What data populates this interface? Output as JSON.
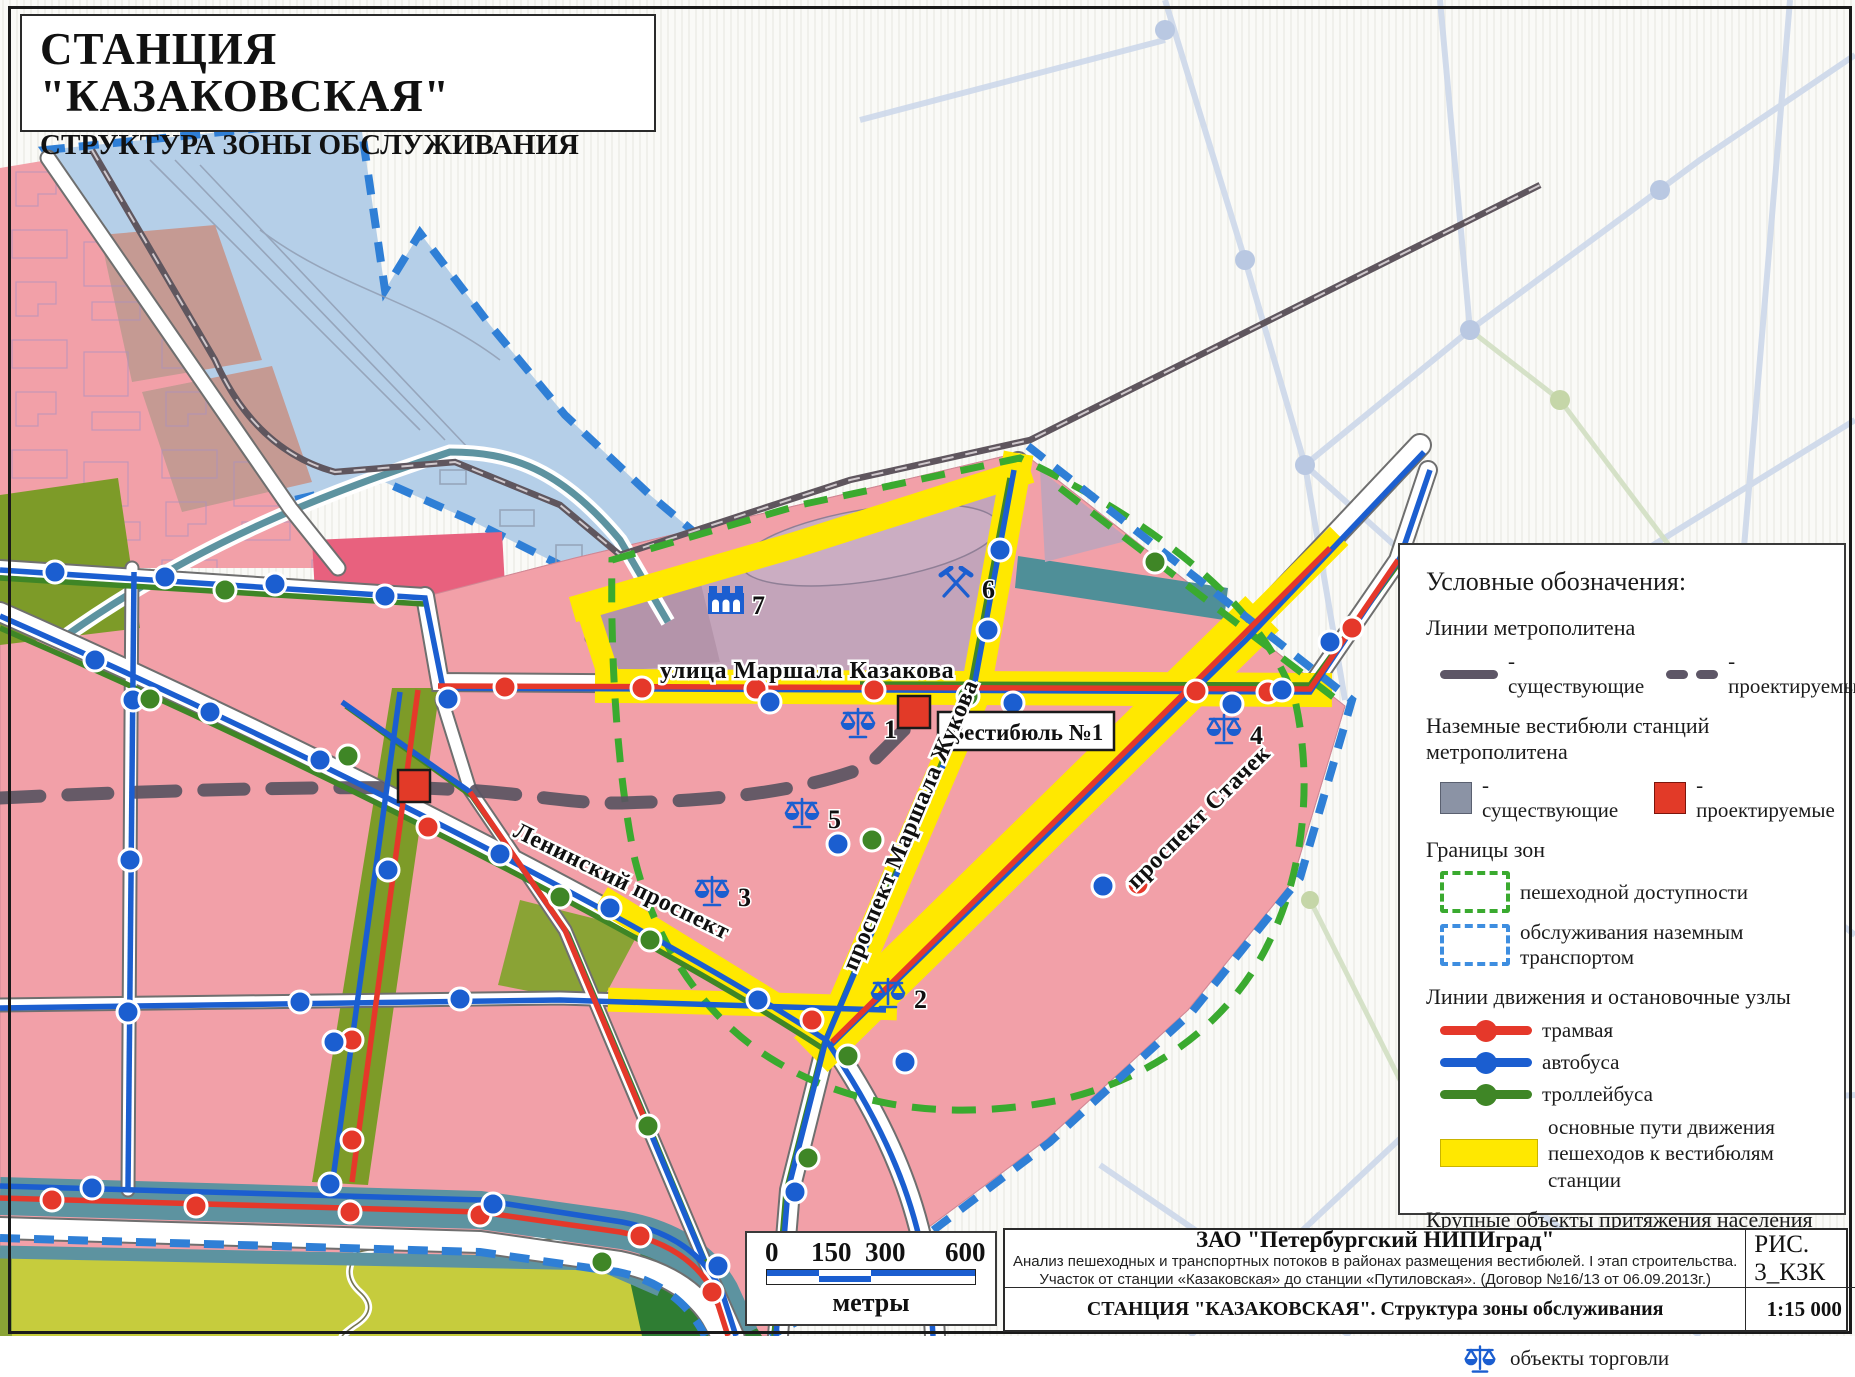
{
  "title_block": {
    "line1": "СТАНЦИЯ \"КАЗАКОВСКАЯ\"",
    "line2": "СТРУКТУРА ЗОНЫ ОБСЛУЖИВАНИЯ"
  },
  "legend": {
    "heading": "Условные обозначения:",
    "metro": {
      "heading": "Линии метрополитена",
      "existing": "- существующие",
      "projected": "- проектируемые"
    },
    "vestibules": {
      "heading": "Наземные вестибюли станций метрополитена",
      "existing": "- существующие",
      "projected": "- проектируемые"
    },
    "zones": {
      "heading": "Границы зон",
      "pedestrian": "пешеходной доступности",
      "transport": "обслуживания наземным транспортом"
    },
    "transit": {
      "heading": "Линии движения и остановочные узлы",
      "tram": "трамвая",
      "bus": "автобуса",
      "trolleybus": "троллейбуса",
      "pedestrian_paths": "основные пути движения пешеходов к вестибюлям станции"
    },
    "attractions": {
      "heading": "Крупные объекты притяжения населения",
      "industrial": "промышленные предприятия",
      "service": "станции технического обслуживания",
      "trade": "объекты торговли"
    }
  },
  "map": {
    "streets": {
      "kazakova": "улица Маршала Казакова",
      "leninsky": "Ленинский проспект",
      "zhukova": "проспект Маршала Жукова",
      "stachek": "проспект Стачек"
    },
    "vestibule1_label": "Вестибюль №1",
    "poi": {
      "p1": "1",
      "p2": "2",
      "p3": "3",
      "p4": "4",
      "p5": "5",
      "p6": "6",
      "p7": "7"
    }
  },
  "scalebar": {
    "t0": "0",
    "t1": "150",
    "t2": "300",
    "t3": "600",
    "unit": "метры"
  },
  "footer": {
    "company": "ЗАО \"Петербургский НИПИград\"",
    "line1": "Анализ пешеходных и транспортных потоков в районах размещения вестибюлей. I этап строительства.",
    "line2": "Участок от станции «Казаковская» до станции «Путиловская». (Договор №16/13 от 06.09.2013г.)",
    "fig": "РИС. 3_КЗК",
    "subtitle": "СТАНЦИЯ \"КАЗАКОВСКАЯ\". Структура зоны обслуживания",
    "scale": "1:15 000"
  },
  "colors": {
    "tram": "#e5382a",
    "bus": "#1b5ed0",
    "trolleybus": "#3f8626",
    "metro": "#5d5666",
    "zone_pedestrian": "#3aaa2f",
    "zone_transport": "#2f7fd6",
    "pedestrian_path": "#ffe800",
    "vestibule_projected": "#e23a28",
    "vestibule_existing": "#8b93a5",
    "residential": "#f2a0a8",
    "industrial_zone": "#c3a4ba",
    "green_zone": "#7d9b28",
    "water_transport_zone": "#b5cfe8",
    "teal_strip": "#5d93a0"
  }
}
